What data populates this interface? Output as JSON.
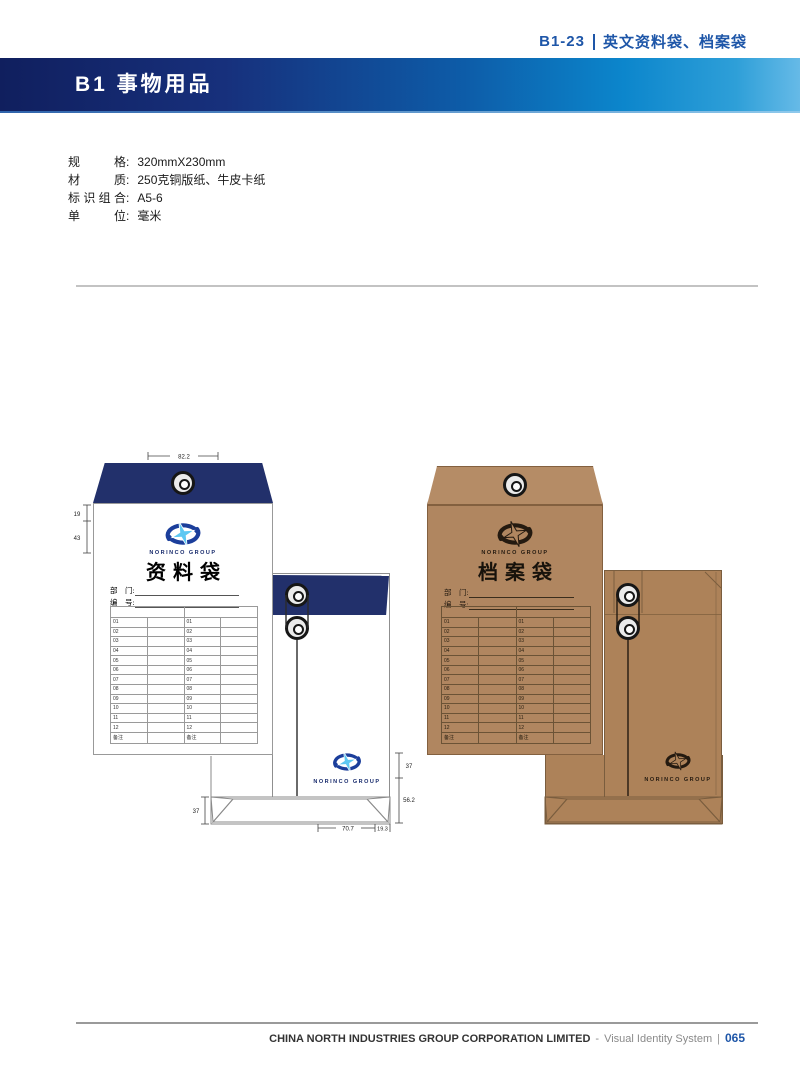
{
  "page": {
    "ref_code": "B1-23",
    "ref_title": "英文资料袋、档案袋",
    "section_title": "B1 事物用品"
  },
  "specs": {
    "rows": [
      {
        "label": "规格",
        "colon": ":",
        "value": "320mmX230mm"
      },
      {
        "label": "材质",
        "colon": ":",
        "value": "250克铜版纸、牛皮卡纸"
      },
      {
        "label": "标识组合",
        "colon": ":",
        "value": "A5-6"
      },
      {
        "label": "单位",
        "colon": ":",
        "value": "毫米"
      }
    ]
  },
  "envelopes": {
    "brand": "NORINCO GROUP",
    "white": {
      "title": "资料袋"
    },
    "kraft": {
      "title": "档案袋"
    },
    "fields": [
      "部　门:",
      "编　号:"
    ],
    "table_rows": [
      "01",
      "02",
      "03",
      "04",
      "05",
      "06",
      "07",
      "08",
      "09",
      "10",
      "11",
      "12",
      "备注"
    ]
  },
  "dims": {
    "top_width": "82.2",
    "flap_h": "19",
    "logo_h": "43",
    "fold_h": "37",
    "back_logo_h": "37",
    "bottom_h": "56.2",
    "bottom_w": "70.7",
    "side_w": "19.3"
  },
  "footer": {
    "company": "CHINA NORTH INDUSTRIES GROUP CORPORATION LIMITED",
    "dash": "-",
    "system": "Visual Identity System",
    "bar": "|",
    "page_number": "065"
  },
  "colors": {
    "navy": "#22306b",
    "brand_blue": "#1b3e9b",
    "star_blue": "#5ec8f2",
    "accent_blue": "#1e56a8",
    "kraft_front": "#b08660",
    "kraft_flap": "#b58c66",
    "kraft_back": "#ad8259"
  }
}
